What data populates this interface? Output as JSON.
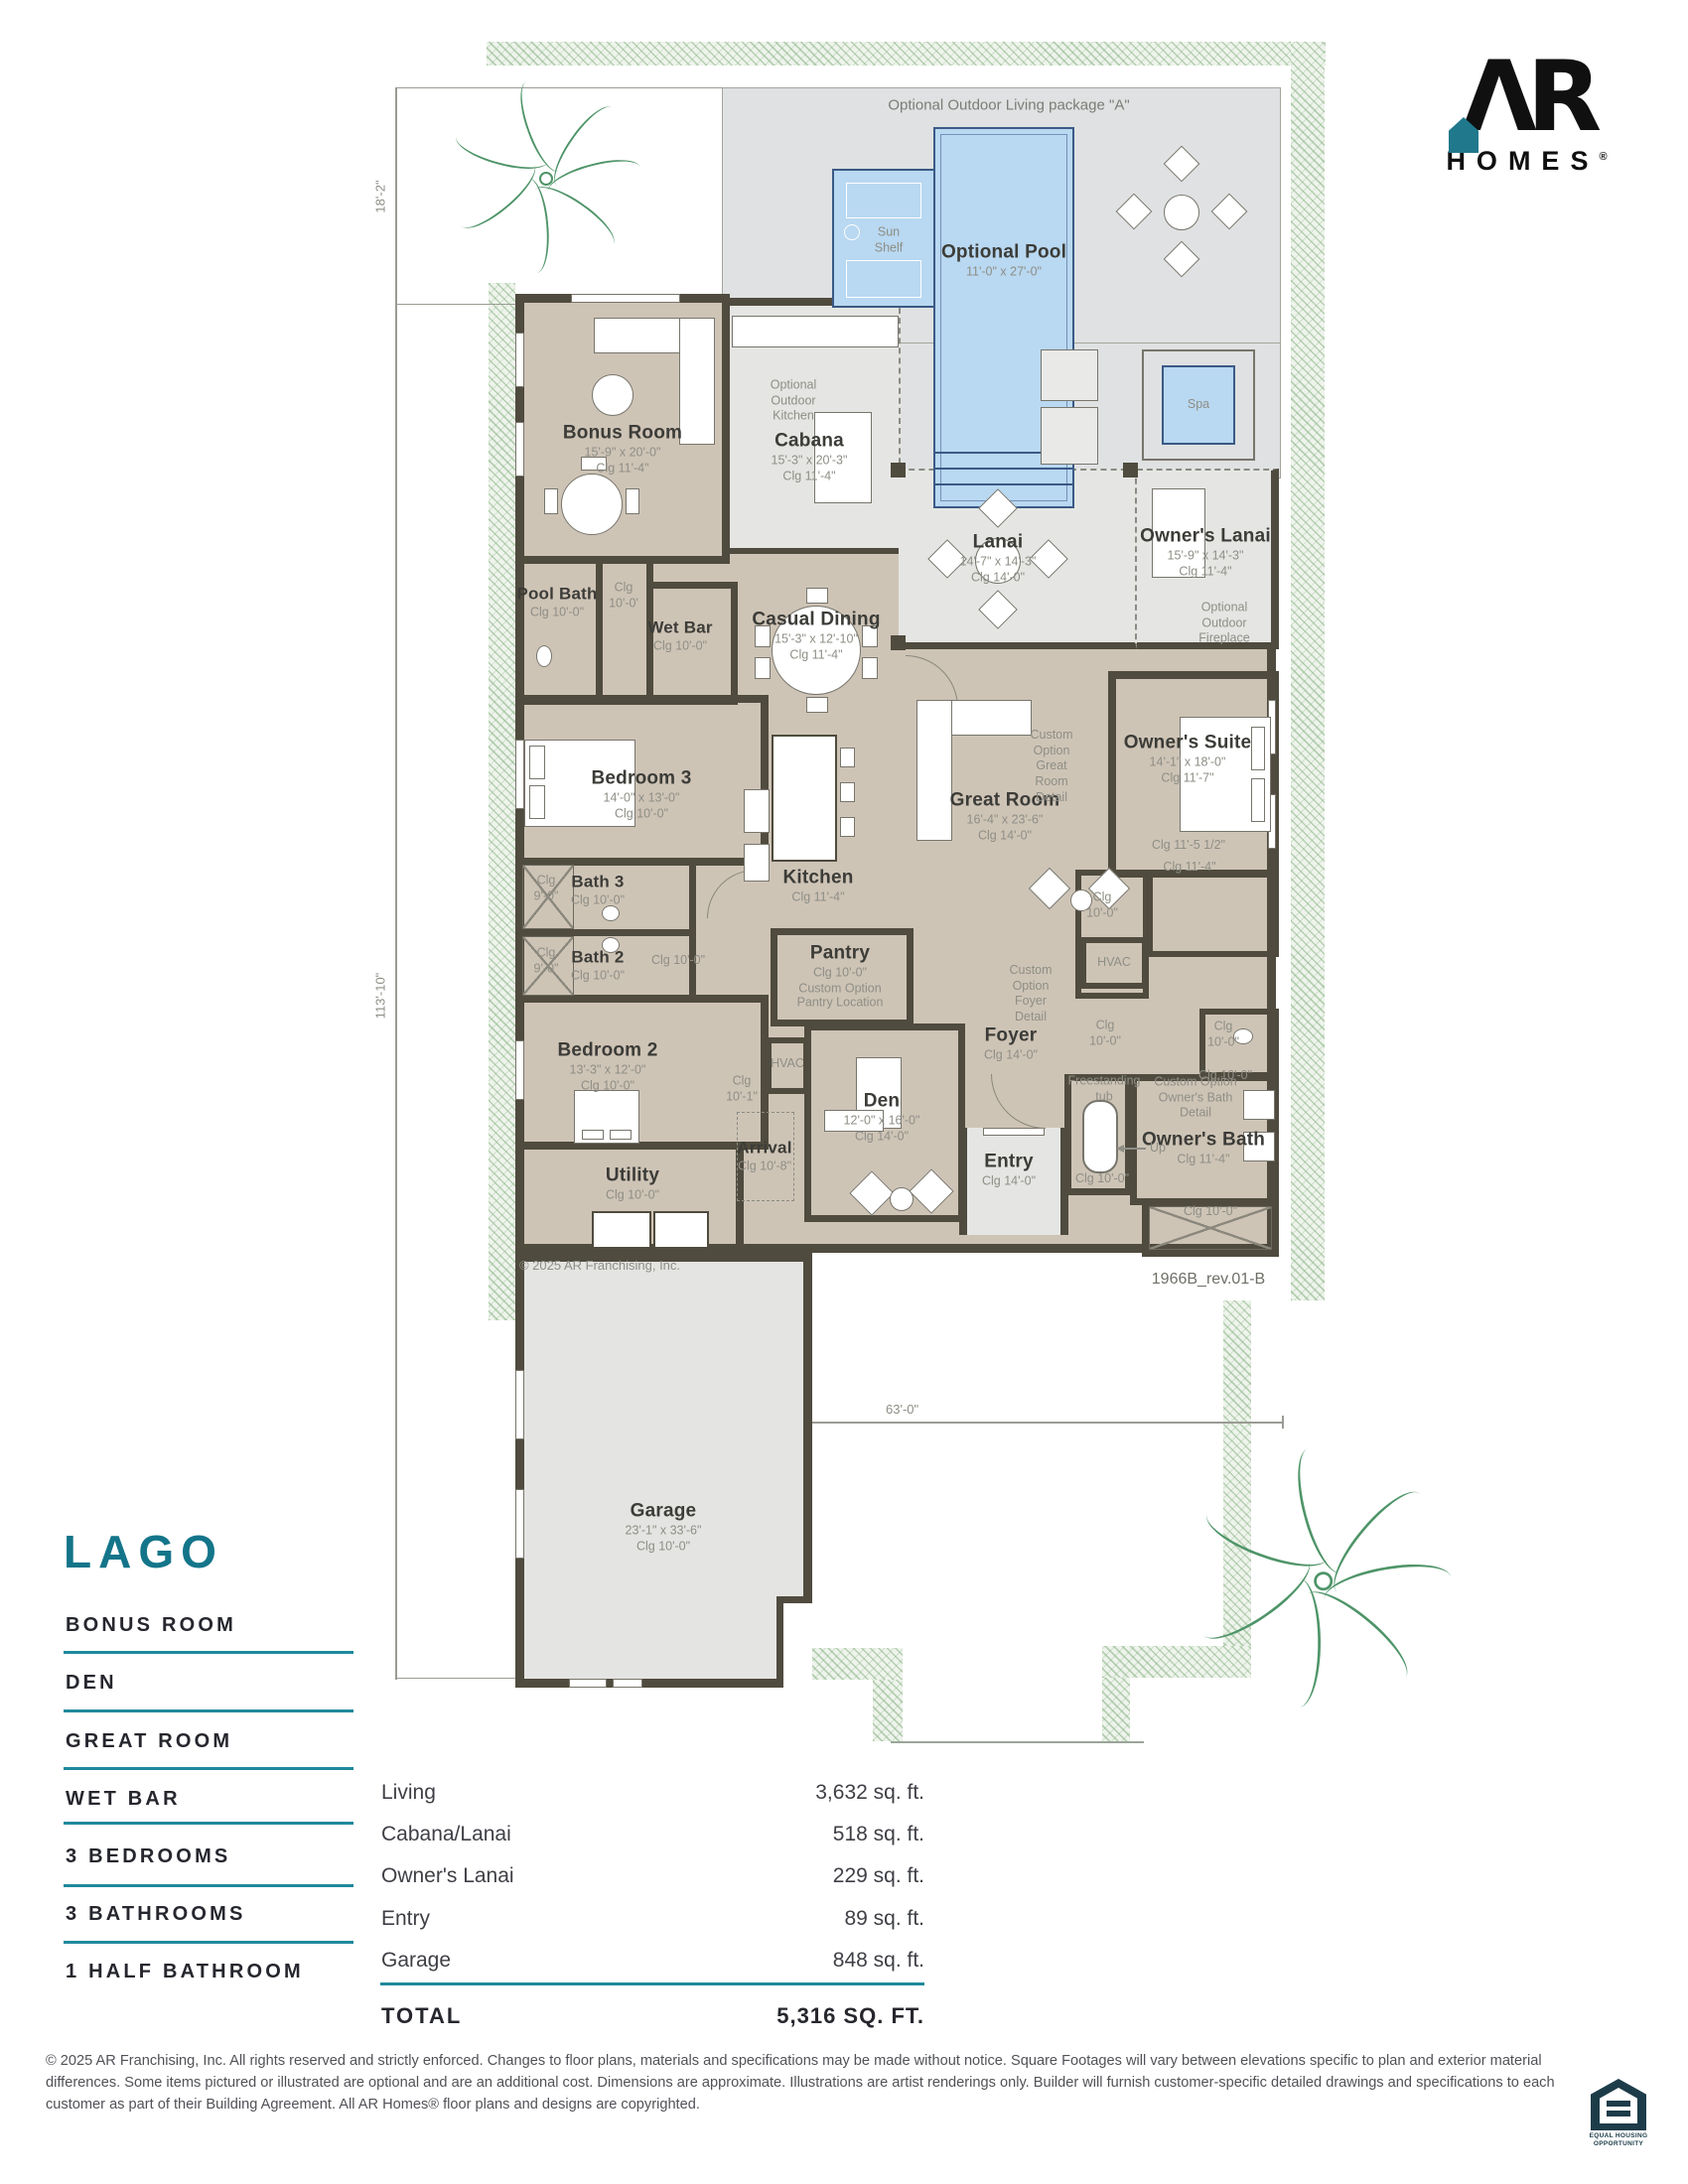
{
  "colors": {
    "accent_teal": "#14758a",
    "rule_teal": "#1f899c",
    "wall": "#4f4b3e",
    "floor_taupe": "#cec4b6",
    "deck_gray": "#dfe1e2",
    "porch_gray": "#e5e6e3",
    "pool_blue": "#b9d8f1",
    "pool_edge": "#3a5a86",
    "hatch_green": "#7eaa78",
    "label_dark": "#3c3c38",
    "label_gray": "#8e8e86",
    "eho_navy": "#1d3c49"
  },
  "logo": {
    "monogram": "ΛR",
    "wordmark": "HOMES",
    "registered": "®"
  },
  "site": {
    "package_label": "Optional Outdoor Living package \"A\"",
    "plan_number": "1966B_rev.01-B",
    "plan_copyright": "© 2025  AR Franchising, Inc.",
    "dim_top": "18'-2\"",
    "dim_left": "113'-10\"",
    "dim_bottom": "63'-0\""
  },
  "rooms": [
    {
      "id": "bonus",
      "name": "Bonus Room",
      "dims": "15'-9\" x 20'-0\"",
      "clg": "Clg 11'-4\""
    },
    {
      "id": "cabana",
      "name": "Cabana",
      "dims": "15'-3\" x 20'-3\"",
      "clg": "Clg 11'-4\""
    },
    {
      "id": "pool",
      "name": "Optional Pool",
      "dims": "11'-0\" x 27'-0\"",
      "clg": ""
    },
    {
      "id": "lanai",
      "name": "Lanai",
      "dims": "14'-7\" x 14'-3\"",
      "clg": "Clg 14'-0\""
    },
    {
      "id": "owners_lanai",
      "name": "Owner's Lanai",
      "dims": "15'-9\" x 14'-3\"",
      "clg": "Clg 11'-4\""
    },
    {
      "id": "pool_bath",
      "name": "Pool Bath",
      "dims": "",
      "clg": "Clg 10'-0\""
    },
    {
      "id": "wet_bar",
      "name": "Wet Bar",
      "dims": "",
      "clg": "Clg 10'-0\""
    },
    {
      "id": "casual",
      "name": "Casual Dining",
      "dims": "15'-3\" x 12'-10\"",
      "clg": "Clg 11'-4\""
    },
    {
      "id": "bed3",
      "name": "Bedroom 3",
      "dims": "14'-0\" x 13'-0\"",
      "clg": "Clg 10'-0\""
    },
    {
      "id": "kitchen",
      "name": "Kitchen",
      "dims": "",
      "clg": "Clg 11'-4\""
    },
    {
      "id": "great",
      "name": "Great Room",
      "dims": "16'-4\" x 23'-6\"",
      "clg": "Clg 14'-0\""
    },
    {
      "id": "owners",
      "name": "Owner's Suite",
      "dims": "14'-1\" x 18'-0\"",
      "clg": "Clg 11'-7\""
    },
    {
      "id": "bath3",
      "name": "Bath 3",
      "dims": "",
      "clg": "Clg 10'-0\""
    },
    {
      "id": "bath2",
      "name": "Bath 2",
      "dims": "",
      "clg": "Clg 10'-0\""
    },
    {
      "id": "pantry",
      "name": "Pantry",
      "dims": "",
      "clg": "Clg 10'-0\"",
      "note": "Custom Option\nPantry Location"
    },
    {
      "id": "foyer",
      "name": "Foyer",
      "dims": "",
      "clg": "Clg 14'-0\""
    },
    {
      "id": "bed2",
      "name": "Bedroom 2",
      "dims": "13'-3\" x 12'-0\"",
      "clg": "Clg 10'-0\""
    },
    {
      "id": "den",
      "name": "Den",
      "dims": "12'-0\" x 16'-0\"",
      "clg": "Clg 14'-0\""
    },
    {
      "id": "arrival",
      "name": "Arrival",
      "dims": "",
      "clg": "Clg 10'-8\""
    },
    {
      "id": "entry",
      "name": "Entry",
      "dims": "",
      "clg": "Clg 14'-0\""
    },
    {
      "id": "obath",
      "name": "Owner's Bath",
      "dims": "",
      "clg": "Clg 11'-4\""
    },
    {
      "id": "utility",
      "name": "Utility",
      "dims": "",
      "clg": "Clg 10'-0\""
    },
    {
      "id": "garage",
      "name": "Garage",
      "dims": "23'-1\" x 33'-6\"",
      "clg": "Clg 10'-0\""
    }
  ],
  "annotations": [
    {
      "id": "a_sun_shelf",
      "text": "Sun\nShelf"
    },
    {
      "id": "a_spa",
      "text": "Spa"
    },
    {
      "id": "a_opt_kitchen",
      "text": "Optional\nOutdoor\nKitchen"
    },
    {
      "id": "a_opt_fireplace",
      "text": "Optional\nOutdoor\nFireplace"
    },
    {
      "id": "a_great_detail",
      "text": "Custom\nOption\nGreat\nRoom\nDetail"
    },
    {
      "id": "a_foyer_detail",
      "text": "Custom\nOption\nFoyer\nDetail"
    },
    {
      "id": "a_obath_detail",
      "text": "Custom Option\nOwner's Bath\nDetail"
    },
    {
      "id": "a_tub",
      "text": "Freestanding\ntub"
    },
    {
      "id": "a_hvac1",
      "text": "HVAC"
    },
    {
      "id": "a_hvac2",
      "text": "HVAC"
    },
    {
      "id": "a_up",
      "text": "Up"
    },
    {
      "id": "a_clg_hall1",
      "text": "Clg\n10'-0'"
    },
    {
      "id": "a_clg_hall2",
      "text": "Clg 10'-0\""
    },
    {
      "id": "a_clg_101",
      "text": "Clg\n10'-1\""
    },
    {
      "id": "a_clg_closL",
      "text": "Clg\n10'-0\""
    },
    {
      "id": "a_clg_1155",
      "text": "Clg 11'-5 1/2\""
    },
    {
      "id": "a_clg_114o",
      "text": "Clg 11'-4\""
    },
    {
      "id": "a_clg_foyc",
      "text": "Clg\n10'-0\""
    },
    {
      "id": "a_clg_wc",
      "text": "Clg\n10'-0\""
    },
    {
      "id": "a_clg_wc2",
      "text": "Clg 10'-0\""
    },
    {
      "id": "a_clg_oshower",
      "text": "Clg 10'-0\""
    },
    {
      "id": "a_clg_tubroom",
      "text": "Clg 10'-0\""
    },
    {
      "id": "a_clg_b3s",
      "text": "Clg\n9'-0\""
    },
    {
      "id": "a_clg_b2s",
      "text": "Clg\n9'-0\""
    }
  ],
  "title_block": {
    "name": "LAGO",
    "features": [
      "BONUS ROOM",
      "DEN",
      "GREAT ROOM",
      "WET BAR",
      "3 BEDROOMS",
      "3 BATHROOMS",
      "1 HALF BATHROOM"
    ],
    "areas": [
      {
        "label": "Living",
        "value": "3,632 sq. ft."
      },
      {
        "label": "Cabana/Lanai",
        "value": "518 sq. ft."
      },
      {
        "label": "Owner's Lanai",
        "value": "229 sq. ft."
      },
      {
        "label": "Entry",
        "value": "89 sq. ft."
      },
      {
        "label": "Garage",
        "value": "848 sq. ft."
      }
    ],
    "total_label": "TOTAL",
    "total_value": "5,316 SQ. FT."
  },
  "footer": {
    "disclaimer": "© 2025 AR Franchising, Inc. All rights reserved and strictly enforced. Changes to floor plans, materials and specifications may be made without notice. Square Footages will vary between elevations specific to plan and exterior material differences. Some items pictured or illustrated are optional and are an additional cost. Dimensions are approximate. Illustrations are artist renderings only. Builder will furnish customer-specific detailed drawings and specifications to each customer as part of their Building Agreement. All AR Homes® floor plans and designs are copyrighted.",
    "eho": "EQUAL HOUSING\nOPPORTUNITY"
  }
}
